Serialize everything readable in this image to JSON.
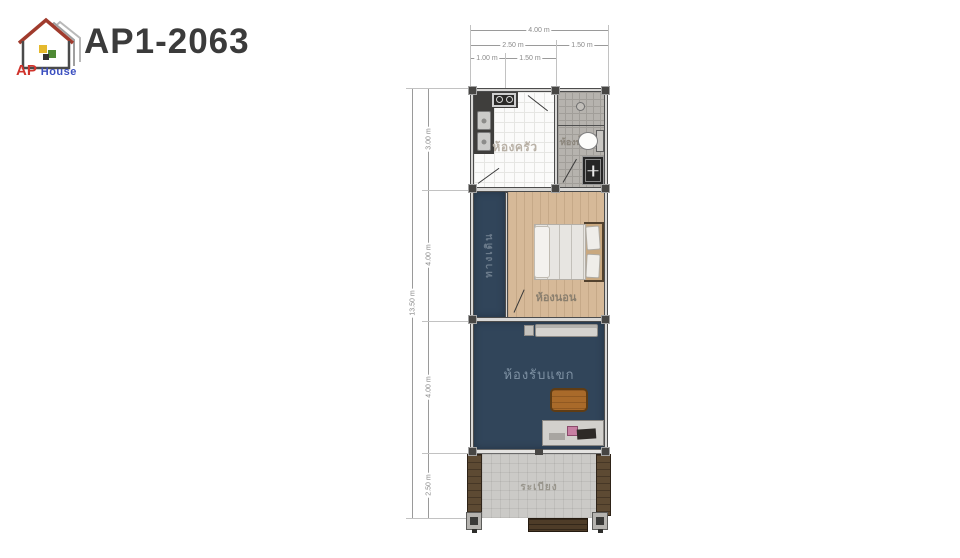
{
  "header": {
    "title": "AP1-2063",
    "logo_ap": "AP",
    "logo_house": "House"
  },
  "dimensions": {
    "top_total": "4.00 m",
    "top_left": "2.50 m",
    "top_right": "1.50 m",
    "top_inner_left": "1.00 m",
    "top_inner_right": "1.50 m",
    "left_total": "13.50 m",
    "left_s1": "3.00 m",
    "left_s2": "4.00 m",
    "left_s3": "4.00 m",
    "left_s4": "2.50 m"
  },
  "rooms": {
    "kitchen": "ห้องครัว",
    "bathroom": "ห้องน้ำ",
    "walkway": "ทางเดิน",
    "bedroom": "ห้องนอน",
    "living_room": "ห้องรับแขก",
    "balcony": "ระเบียง"
  },
  "colors": {
    "navy_floor": "#31455a",
    "wood_floor": "#d6b998",
    "bath_tile": "#b6b3ae",
    "balcony_floor": "#cbcac7",
    "wood_wall": "#5d4a33",
    "table_brown": "#a96a2a",
    "logo_red": "#d0342c",
    "logo_blue": "#3b4fc0",
    "title_gray": "#3b3b3b"
  }
}
